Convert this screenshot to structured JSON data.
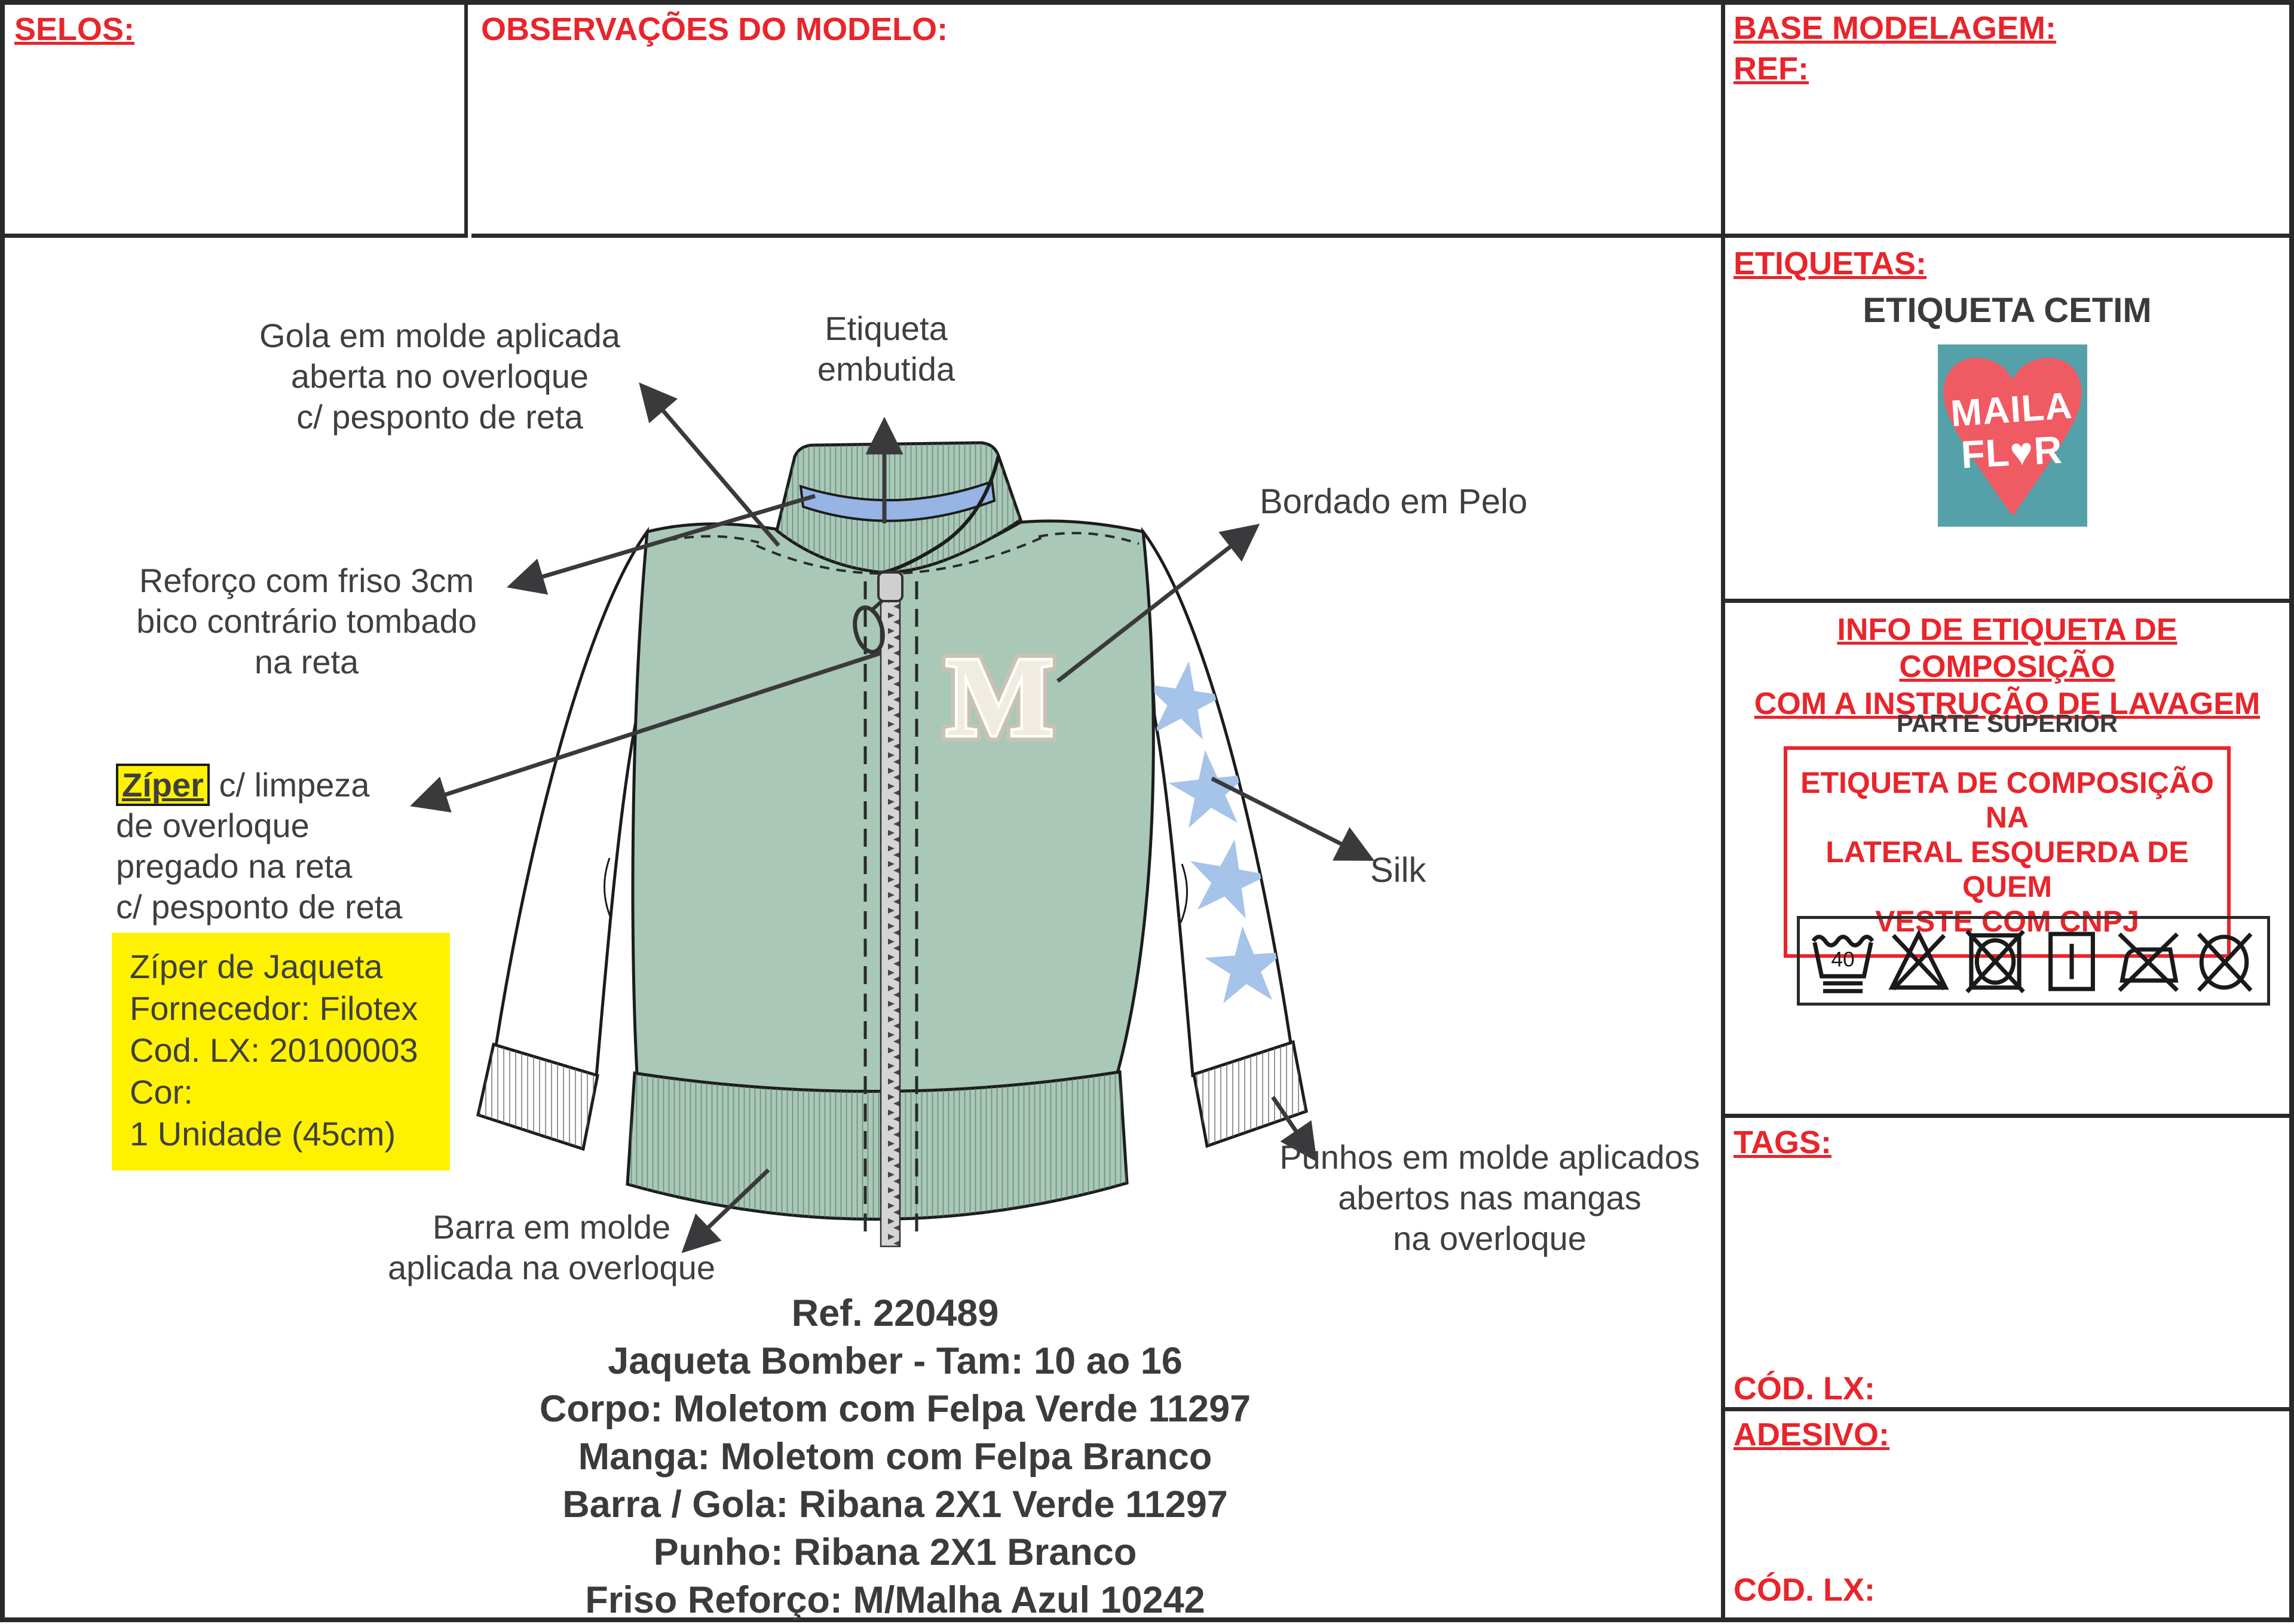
{
  "header": {
    "selos": "SELOS:",
    "observacoes": "OBSERVAÇÕES DO MODELO:",
    "base_modelagem": "BASE MODELAGEM:",
    "ref": "REF:"
  },
  "colors": {
    "red": "#e8252b",
    "dark_text": "#3f3f41",
    "body_green": "#a9c8b7",
    "inner_collar_blue": "#96b4e4",
    "star_blue": "#a6c3e9",
    "highlight_yellow": "#fff200",
    "logo_teal": "#55a1aa",
    "logo_coral": "#f05a63",
    "outline": "#1c1c1c"
  },
  "drawing": {
    "labels": {
      "gola": "Gola em molde aplicada\naberta no overloque\nc/ pesponto de reta",
      "etiqueta": "Etiqueta\nembutida",
      "reforco": "Reforço com friso 3cm\nbico contrário tombado\nna reta",
      "ziper_word": "Zíper",
      "ziper_rest": " c/ limpeza",
      "ziper_lines": "de overloque\npregado na reta\n c/ pesponto de reta",
      "bordado": "Bordado em Pelo",
      "silk": "Silk",
      "punhos": "Punhos em molde aplicados\nabertos nas mangas\nna overloque",
      "barra": "Barra em molde\naplicada na overloque"
    },
    "ziper_box": "Zíper de Jaqueta\nFornecedor: Filotex\nCod. LX: 20100003\nCor:\n1 Unidade (45cm)",
    "patch_letter": "M",
    "spec_block": "Ref. 220489\nJaqueta Bomber - Tam: 10 ao 16\nCorpo: Moletom com Felpa Verde 11297\nManga: Moletom com Felpa Branco\nBarra / Gola: Ribana 2X1 Verde 11297\nPunho: Ribana 2X1 Branco\nFriso Reforço: M/Malha Azul 10242"
  },
  "right_column": {
    "etiquetas_label": "ETIQUETAS:",
    "etiqueta_type": "ETIQUETA CETIM",
    "logo": {
      "line1": "MAILA",
      "line2": "FL♥R"
    },
    "info_title": "INFO DE ETIQUETA DE COMPOSIÇÃO\nCOM A INSTRUÇÃO DE LAVAGEM",
    "parte_superior": "PARTE SUPERIOR",
    "composicao_box": "ETIQUETA DE COMPOSIÇÃO NA\nLATERAL ESQUERDA DE QUEM\nVESTE COM CNPJ",
    "care": {
      "wash_temp": "40",
      "symbols": [
        "wash-40-delicate",
        "do-not-bleach",
        "do-not-tumble-dry",
        "drip-dry",
        "do-not-iron",
        "do-not-dry-clean"
      ]
    },
    "tags_label": "TAGS:",
    "cod_lx_label": "CÓD. LX:",
    "adesivo_label": "ADESIVO:",
    "cod_lx_label_2": "CÓD. LX:"
  }
}
